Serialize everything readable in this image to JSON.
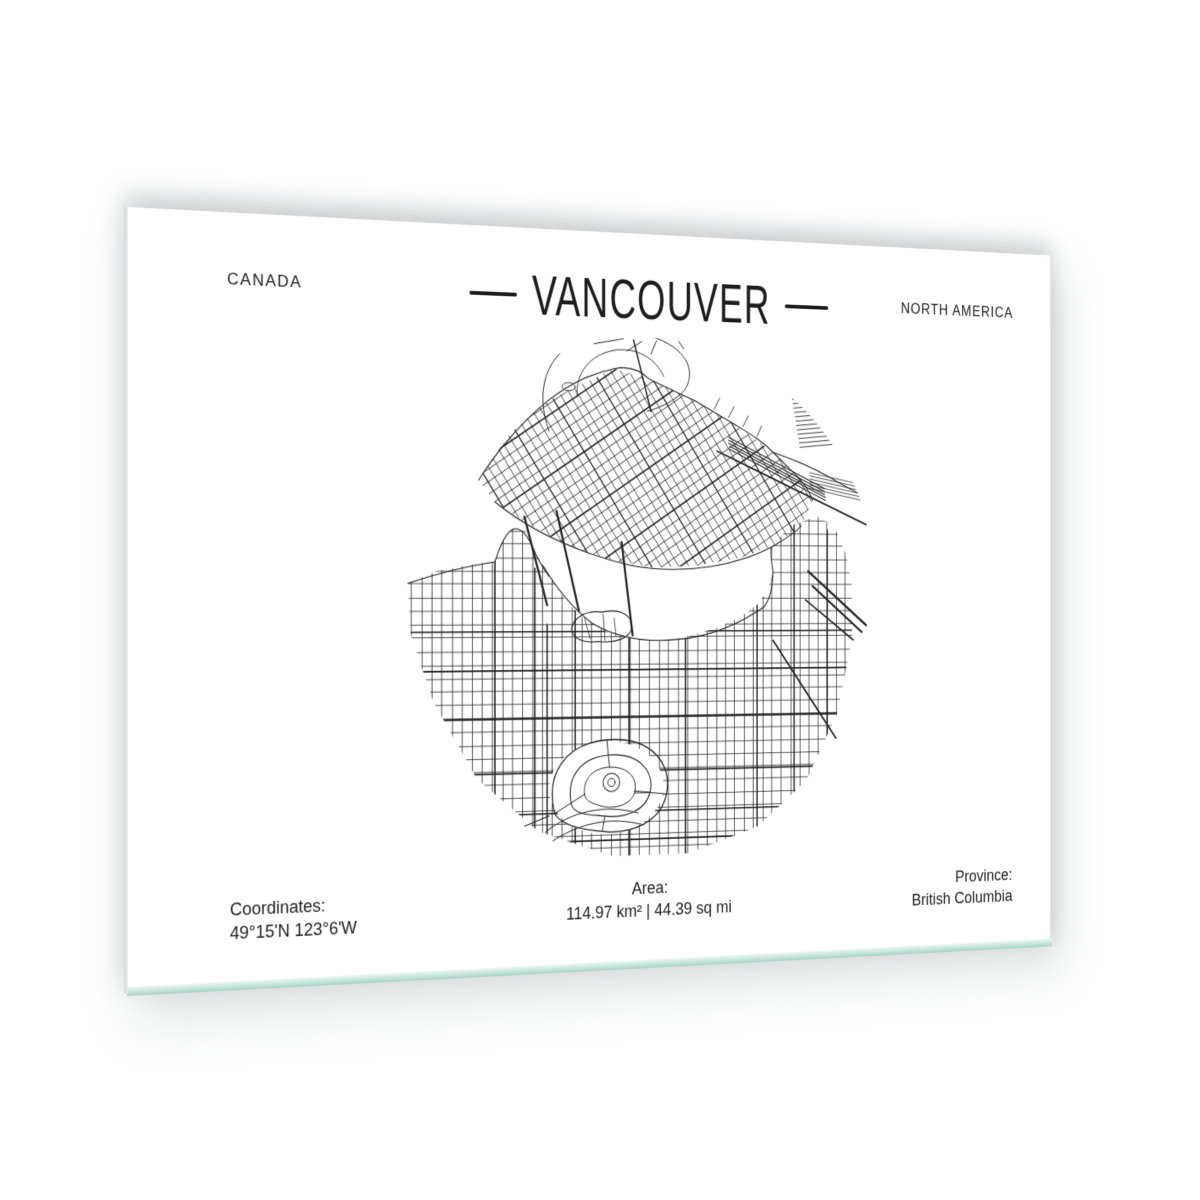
{
  "artwork": {
    "country": "CANADA",
    "city": "VANCOUVER",
    "continent": "NORTH AMERICA",
    "coordinates_label": "Coordinates:",
    "coordinates_value": "49°15'N 123°6'W",
    "area_label": "Area:",
    "area_value": "114.97 km² | 44.39 sq mi",
    "province_label": "Province:",
    "province_value": "British Columbia",
    "colors": {
      "ink": "#232323",
      "panel": "#ffffff",
      "background": "#ffffff",
      "glass_edge": "#a6d4c6"
    }
  }
}
